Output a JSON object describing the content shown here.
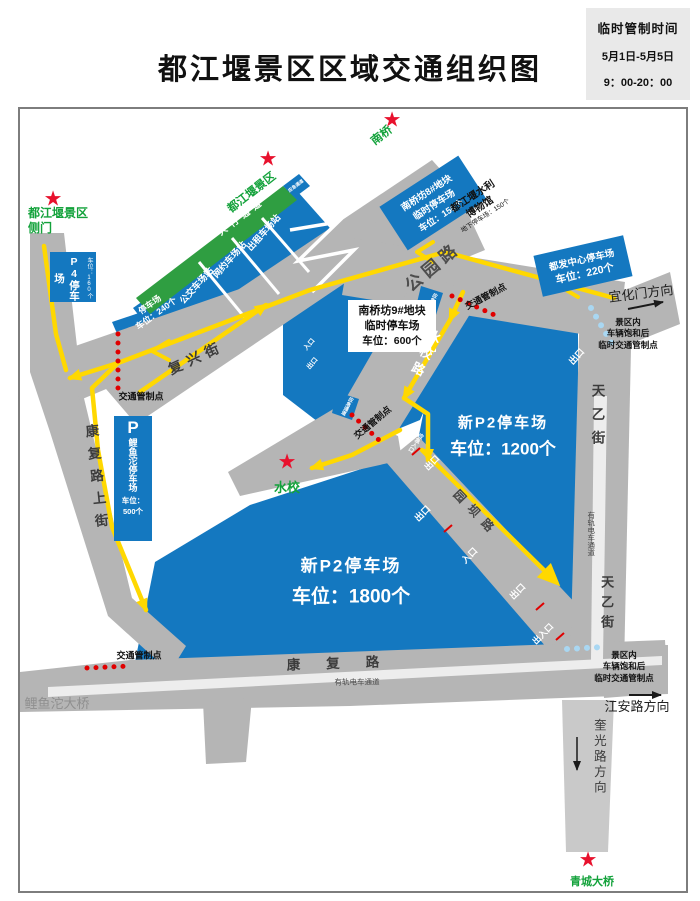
{
  "title": "都江堰景区区域交通组织图",
  "notice": {
    "title": "临时管制时间",
    "date": "5月1日-5月5日",
    "time": "9：00-20：00"
  },
  "stars": {
    "icon": "★",
    "side_gate_1": "都江堰景区",
    "side_gate_2": "侧门",
    "scenic": "都江堰景区",
    "nanqiao": "南桥",
    "shuixiao": "水校",
    "qingcheng": "青城大桥"
  },
  "parking": {
    "p4": {
      "name": "P4停车场",
      "cap": "车位：160个"
    },
    "strip": {
      "name": "停车场",
      "cap": "车位：240个",
      "bus": "公交车场站",
      "rideshare": "网约车场站",
      "taxi": "出租车场站"
    },
    "nq8": {
      "l1": "南桥坊8#地块",
      "l2": "临时停车场",
      "cap": "车位：150个"
    },
    "nq9": {
      "l1": "南桥坊9#地块",
      "l2": "临时停车场",
      "cap": "车位：600个"
    },
    "dufa": {
      "name": "都发中心停车场",
      "cap": "车位：220个"
    },
    "museum": {
      "l1": "都江堰水利",
      "l2": "博物馆",
      "cap": "地下停车场：150个"
    },
    "p2_1200": {
      "name": "新P2停车场",
      "cap": "车位：1200个"
    },
    "p2_1800": {
      "name": "新P2停车场",
      "cap": "车位：1800个"
    },
    "liyutuo": {
      "p": "P",
      "name": "鲤鱼沱停车场",
      "cap1": "车位：",
      "cap2": "500个"
    }
  },
  "roads": {
    "gongyuan": "公园路",
    "shuixiao": "水校路",
    "fuxing": "复兴街",
    "kangfu_upper": "康复路上街",
    "kangfu": "康复路",
    "tianyi": "天乙街",
    "yuanba": "园坝路"
  },
  "markers": {
    "control": "交通管制点",
    "sat1": "景区内",
    "sat2": "车辆饱和后",
    "sat3": "临时交通管制点",
    "pedestrian": "人行通道",
    "emergency_lane": "应急通道",
    "emergency_entrance": "应急入口",
    "tram": "有轨电车通道",
    "exit": "出口",
    "entrance": "入口",
    "exit_entrance": "出入口"
  },
  "directions": {
    "yihuamen": "宜化门方向",
    "jiangan": "江安路方向",
    "kuiguang": "奎光路方向",
    "liyutuo_bridge": "鲤鱼沱大桥"
  },
  "colors": {
    "parking_blue": "#1478c0",
    "pedestrian_green": "#2f9e41",
    "route_yellow": "#ffd800",
    "control_red": "#e00000",
    "saturation_blue": "#a9d7f2",
    "road_gray": "#b5b5b5",
    "star_red": "#e8112d"
  }
}
